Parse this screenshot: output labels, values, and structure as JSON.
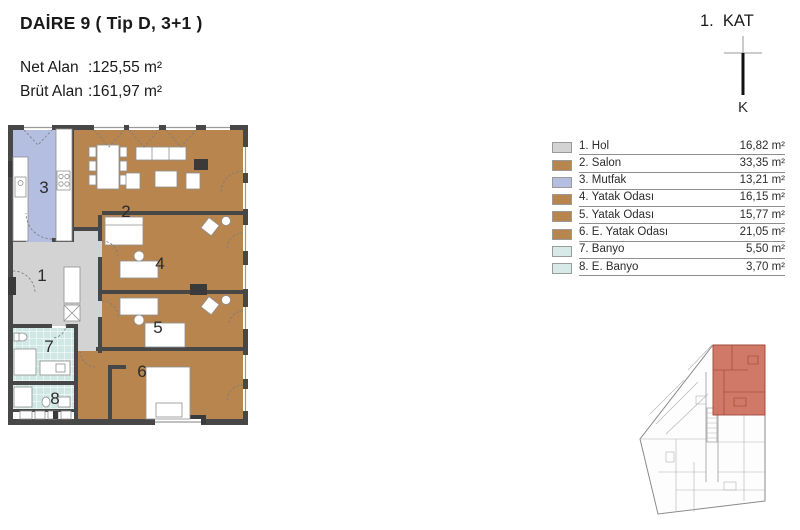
{
  "header": {
    "title": "DAİRE 9 ( Tip D, 3+1 )",
    "net_alan_label": "Net Alan",
    "net_alan_value": ":125,55 m²",
    "brut_alan_label": "Brüt Alan",
    "brut_alan_value": ":161,97 m²"
  },
  "floor_indicator": {
    "label": "1.  KAT",
    "north_label": "K"
  },
  "legend": {
    "items": [
      {
        "label": "1. Hol",
        "area": "16,82 m²",
        "color": "#d3d3d3"
      },
      {
        "label": "2. Salon",
        "area": "33,35 m²",
        "color": "#b8854f"
      },
      {
        "label": "3. Mutfak",
        "area": "13,21 m²",
        "color": "#b3bee0"
      },
      {
        "label": "4. Yatak Odası",
        "area": "16,15 m²",
        "color": "#b8854f"
      },
      {
        "label": "5. Yatak Odası",
        "area": "15,77 m²",
        "color": "#b8854f"
      },
      {
        "label": "6. E. Yatak Odası",
        "area": "21,05 m²",
        "color": "#b8854f"
      },
      {
        "label": "7. Banyo",
        "area": "5,50 m²",
        "color": "#d8eae7"
      },
      {
        "label": "8. E. Banyo",
        "area": "3,70 m²",
        "color": "#d8eae7"
      }
    ]
  },
  "plan": {
    "room_numbers": {
      "hol": "1",
      "salon": "2",
      "mutfak": "3",
      "yatak1": "4",
      "yatak2": "5",
      "e_yatak": "6",
      "banyo": "7",
      "e_banyo": "8"
    }
  },
  "colors": {
    "room_brown": "#b8854f",
    "room_gray": "#d3d3d3",
    "room_lavender": "#b3bee0",
    "room_tile": "#cfe8e4",
    "wall": "#474747",
    "site_highlight": "#cf7260"
  }
}
